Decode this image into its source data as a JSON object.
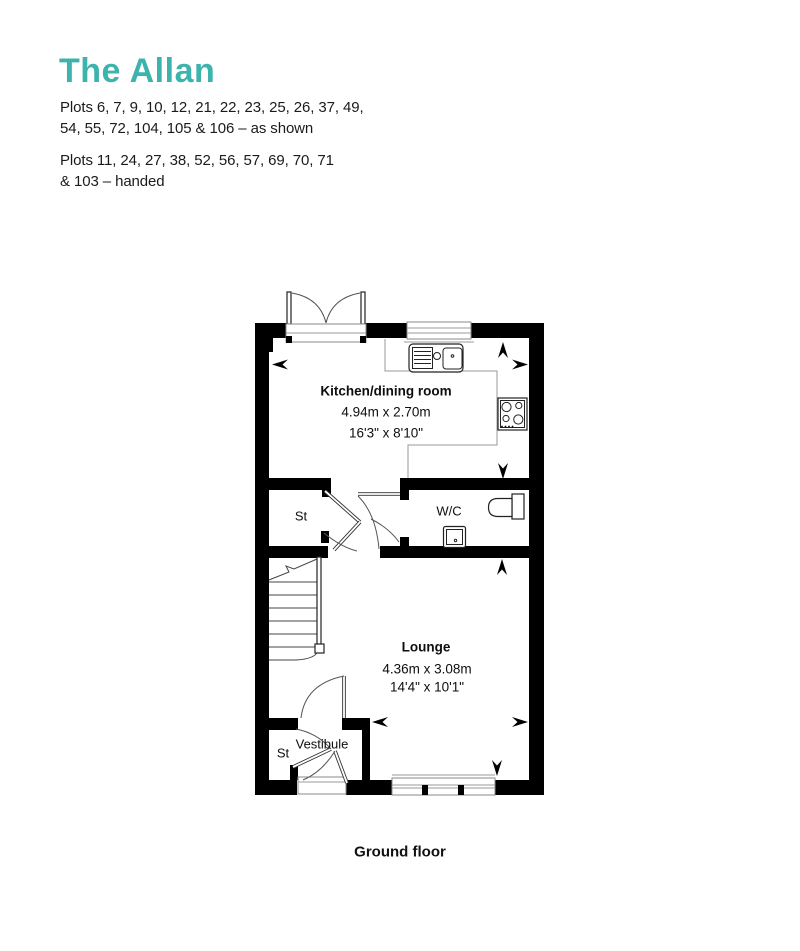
{
  "header": {
    "title": "The Allan",
    "plots_as_shown": "Plots 6, 7, 9, 10, 12, 21, 22, 23, 25, 26, 37, 49,\n54, 55, 72, 104, 105 & 106 – as shown",
    "plots_handed": "Plots 11, 24, 27, 38, 52, 56, 57, 69, 70, 71\n& 103 – handed"
  },
  "rooms": {
    "kitchen": {
      "name": "Kitchen/dining room",
      "metric": "4.94m x 2.70m",
      "imperial": "16'3\" x 8'10\""
    },
    "lounge": {
      "name": "Lounge",
      "metric": "4.36m x 3.08m",
      "imperial": "14'4\" x 10'1\""
    },
    "wc": {
      "name": "W/C"
    },
    "store_hall": {
      "name": "St"
    },
    "store_vestibule": {
      "name": "St"
    },
    "vestibule": {
      "name": "Vestibule"
    }
  },
  "caption": "Ground floor",
  "colors": {
    "accent": "#3DB3AD",
    "wall": "#000000"
  }
}
